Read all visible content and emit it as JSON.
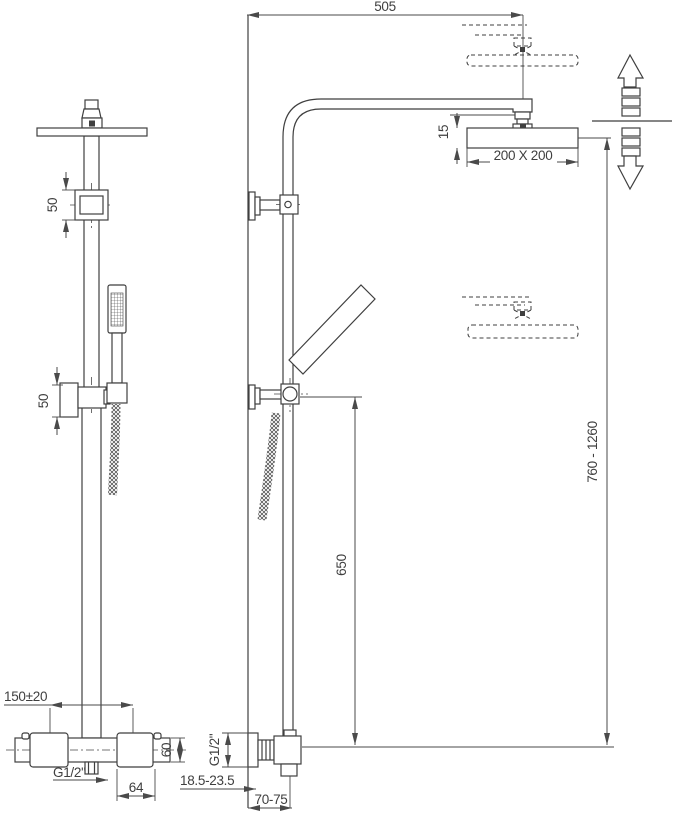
{
  "drawing": {
    "kind": "technical-dimension-drawing",
    "colors": {
      "line": "#3f3f3f",
      "background": "#ffffff"
    },
    "dimensions": {
      "arm_reach": "505",
      "head_size": "200 X 200",
      "head_thickness": "15",
      "upper_bracket_height": "50",
      "handset_holder_height": "50",
      "height_range": "760 - 1260",
      "holder_to_valve": "650",
      "valve_inlet_spacing": "150±20",
      "valve_body_height": "60",
      "valve_outlet_thread": "G1/2\"",
      "valve_inlet_thread": "G1/2\"",
      "handle_width": "64",
      "wall_depth_adjustment": "18.5-23.5",
      "valve_projection": "70-75"
    }
  }
}
